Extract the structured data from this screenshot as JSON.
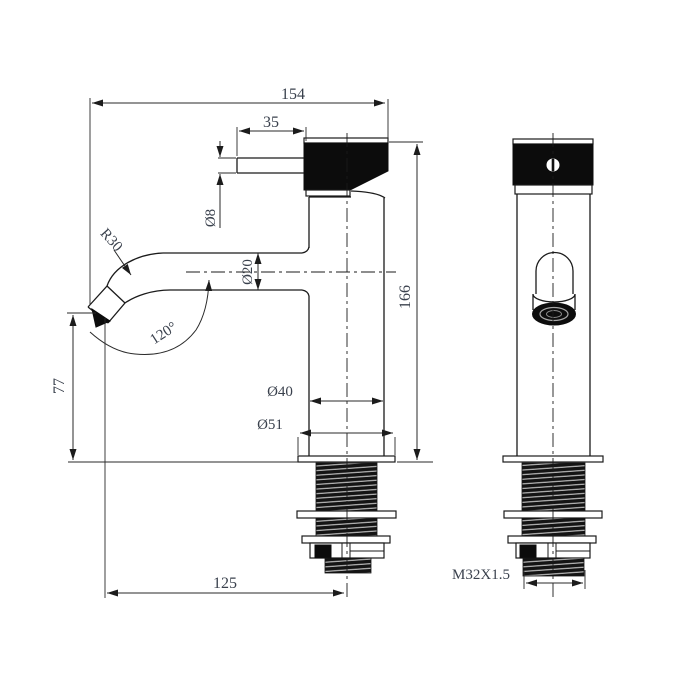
{
  "drawing": {
    "title": "basin-faucet-technical-drawing",
    "colors": {
      "line": "#1b1b1b",
      "text": "#3a414d",
      "fill": "#0c0c0c",
      "background": "#ffffff"
    },
    "dimensions": {
      "overall_width": "154",
      "handle_lever_length": "35",
      "handle_rod_diameter": "Ø8",
      "spout_bend_radius": "R30",
      "spout_tube_diameter": "Ø20",
      "spout_angle": "120°",
      "body_height": "166",
      "spout_tip_height": "77",
      "body_diameter": "Ø40",
      "base_flange_diameter": "Ø51",
      "spout_reach": "125",
      "inlet_thread_spec": "M32X1.5"
    }
  }
}
